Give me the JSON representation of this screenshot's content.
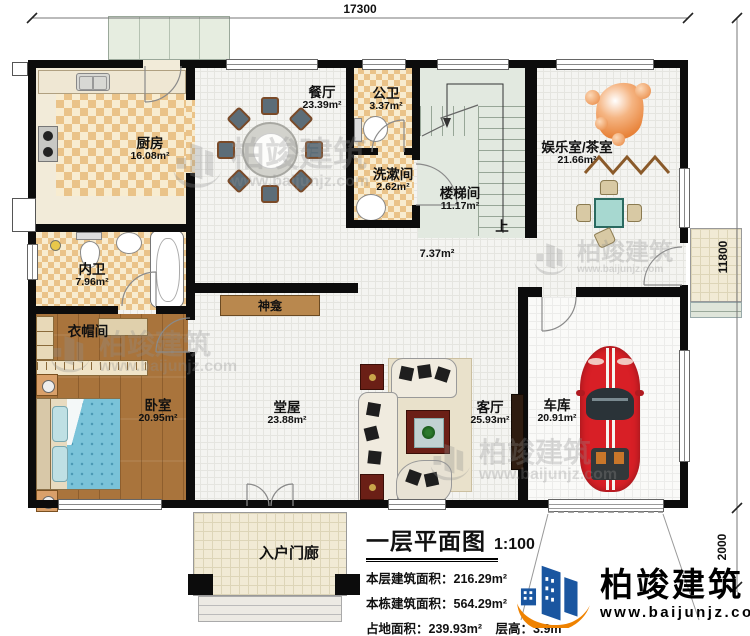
{
  "dimensions": {
    "top": "17300",
    "right_upper": "11800",
    "right_lower": "2000"
  },
  "rooms": [
    {
      "id": "kitchen",
      "name": "厨房",
      "area": "16.08m²"
    },
    {
      "id": "dining",
      "name": "餐厅",
      "area": "23.39m²"
    },
    {
      "id": "public-wc",
      "name": "公卫",
      "area": "3.37m²"
    },
    {
      "id": "washroom",
      "name": "洗漱间",
      "area": "2.62m²"
    },
    {
      "id": "stairwell",
      "name": "楼梯间",
      "area": "11.17m²"
    },
    {
      "id": "corridor",
      "name": "",
      "area": "7.37m²"
    },
    {
      "id": "entertainment",
      "name": "娱乐室/茶室",
      "area": "21.66m²"
    },
    {
      "id": "inner-bath",
      "name": "内卫",
      "area": "7.96m²"
    },
    {
      "id": "cloakroom",
      "name": "衣帽间",
      "area": ""
    },
    {
      "id": "bedroom",
      "name": "卧室",
      "area": "20.95m²"
    },
    {
      "id": "hall",
      "name": "堂屋",
      "area": "23.88m²"
    },
    {
      "id": "living",
      "name": "客厅",
      "area": "25.93m²"
    },
    {
      "id": "garage",
      "name": "车库",
      "area": "20.91m²"
    },
    {
      "id": "entry-porch",
      "name": "入户门廊",
      "area": ""
    }
  ],
  "annotations": {
    "shrine": "神龛",
    "stairs_up": "上"
  },
  "info_block": {
    "title": "一层平面图",
    "scale": "1:100",
    "rows": [
      {
        "label": "本层建筑面积：",
        "value": "216.29m²"
      },
      {
        "label": "本栋建筑面积：",
        "value": "564.29m²"
      },
      {
        "label": "占地面积：",
        "value": "239.93m²"
      },
      {
        "label": "层高：",
        "value": "3.9m"
      }
    ]
  },
  "brand": {
    "name": "柏竣建筑",
    "url": "www.baijunjz.com"
  },
  "colors": {
    "wall": "#0c0c0c",
    "brand_blue": "#1a56a0",
    "brand_orange": "#ef8200",
    "checker": "#eac389",
    "tile": "#f4f4f1",
    "wood": "#a9743c",
    "stair_green": "#e2e9e0",
    "car_red": "#d81f26",
    "bed_blue": "#7ac3d9",
    "tea_table": "#a7d8d0"
  }
}
